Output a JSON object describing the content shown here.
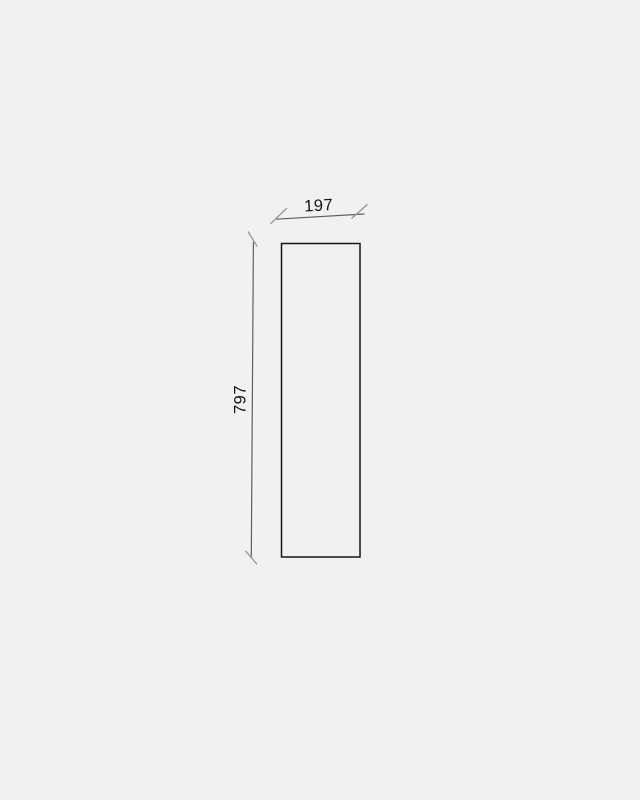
{
  "drawing": {
    "type": "technical-dimension-drawing",
    "shape": "rectangle",
    "width_dimension": {
      "label": "197",
      "orientation": "horizontal",
      "position": "top"
    },
    "height_dimension": {
      "label": "797",
      "orientation": "vertical",
      "position": "left"
    }
  },
  "colors": {
    "background": "#f1f1f1",
    "outline": "#161616",
    "dimension_line": "#606060",
    "tick": "#9a9a9a",
    "label_text": "#121212"
  }
}
